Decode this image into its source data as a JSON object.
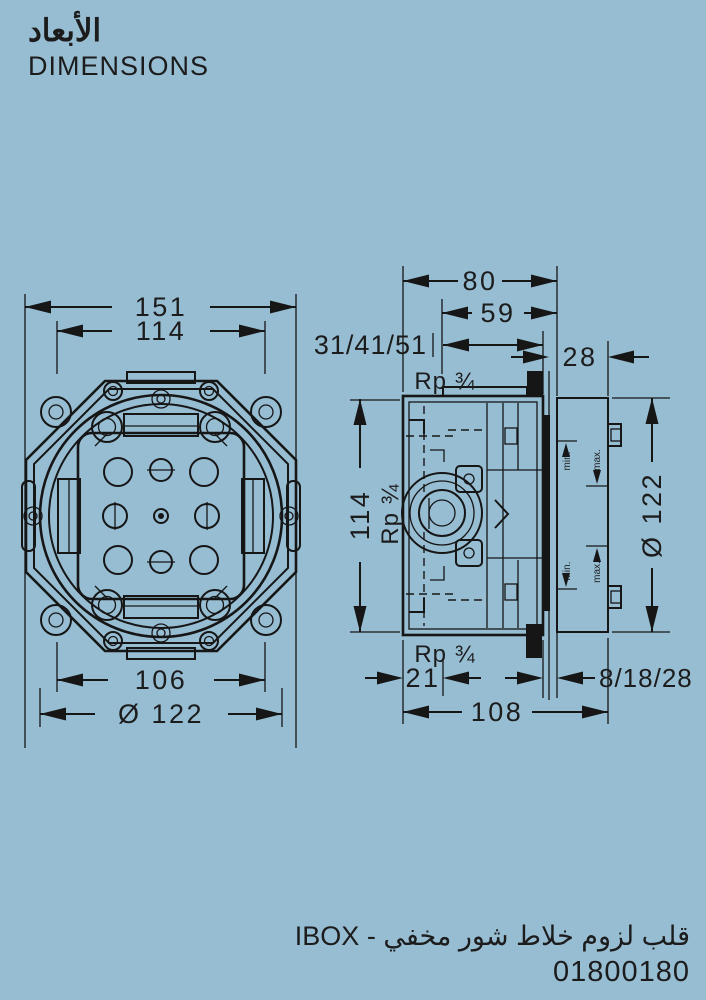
{
  "header": {
    "title_ar": "الأبعاد",
    "title_en": "DIMENSIONS"
  },
  "front_view": {
    "flange_width": "151",
    "plate_width": "114",
    "bracket_span": "106",
    "body_diameter": "Ø 122"
  },
  "side_view": {
    "total_depth": "80",
    "body_depth": "59",
    "install_depth_range": "31/41/51",
    "plate_depth": "28",
    "body_height": "114",
    "plate_diameter": "Ø 122",
    "thread_top": "Rp ¾",
    "thread_side": "Rp ¾",
    "thread_bottom": "Rp ¾",
    "offset_bottom": "21",
    "plaster_range": "8/18/28",
    "overall_depth": "108",
    "min_label": "min.",
    "max_label": "max."
  },
  "footer": {
    "caption_ar": "قلب لزوم خلاط شور مخفي - IBOX",
    "product_code": "01800180"
  }
}
